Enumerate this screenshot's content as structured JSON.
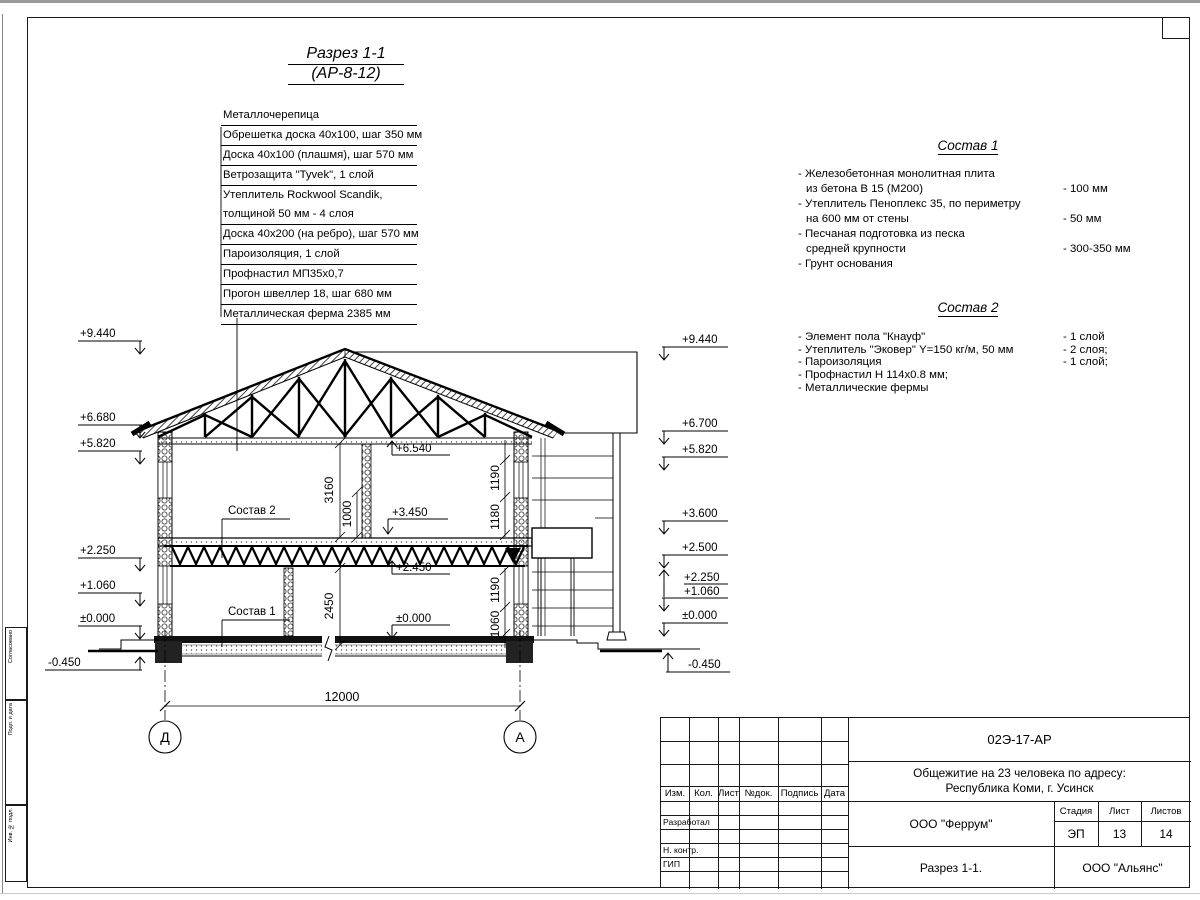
{
  "drawing_title": {
    "line1": "Разрез 1-1",
    "line2": "(АР-8-12)"
  },
  "materials": {
    "rows": [
      {
        "text": "Металлочерепица"
      },
      {
        "text": "Обрешетка доска 40х100, шаг 350 мм"
      },
      {
        "text": "Доска 40х100 (плашмя), шаг 570 мм"
      },
      {
        "text": "Ветрозащита \"Tyvek\", 1 слой"
      },
      {
        "text": "Утеплитель Rockwool Scandik,"
      },
      {
        "text": "толщиной 50 мм - 4 слоя"
      },
      {
        "text": "Доска 40х200 (на ребро), шаг 570 мм"
      },
      {
        "text": "Пароизоляция, 1 слой"
      },
      {
        "text": "Профнастил МП35х0,7"
      },
      {
        "text": "Прогон швеллер 18, шаг 680 мм"
      },
      {
        "text": "Металлическая ферма 2385 мм"
      }
    ]
  },
  "sostav1": {
    "title": "Состав 1",
    "items": [
      {
        "l1": "- Железобетонная  монолитная плита",
        "l2": "из бетона В 15 (М200)",
        "value": "- 100 мм"
      },
      {
        "l1": "- Утеплитель Пеноплекс 35, по периметру",
        "l2": "на 600 мм от стены",
        "value": "- 50 мм"
      },
      {
        "l1": "- Песчаная подготовка из песка",
        "l2": "средней крупности",
        "value": "- 300-350 мм"
      },
      {
        "l1": "- Грунт основания",
        "value": ""
      }
    ]
  },
  "sostav2": {
    "title": "Состав 2",
    "items": [
      {
        "l1": "- Элемент пола \"Кнауф\"",
        "value": "- 1 слой"
      },
      {
        "l1": "- Утеплитель \"Эковер\" Y=150 кг/м, 50 мм",
        "value": "- 2 слоя;"
      },
      {
        "l1": "- Пароизоляция",
        "value": "- 1 слой;"
      },
      {
        "l1": "- Профнастил Н 114х0.8 мм;",
        "value": ""
      },
      {
        "l1": "- Металлические фермы",
        "value": ""
      }
    ]
  },
  "drawing": {
    "elevations_left": [
      "+9.440",
      "+6.680",
      "+5.820",
      "+2.250",
      "+1.060",
      "±0.000",
      "-0.450"
    ],
    "elevations_right": [
      "+9.440",
      "+6.700",
      "+5.820",
      "+3.600",
      "+2.500",
      "+2.250",
      "+1.060",
      "±0.000",
      "-0.450"
    ],
    "elevations_inner": [
      "+6.540",
      "+3.450",
      "+2.450",
      "±0.000"
    ],
    "dims_left": [
      "3160",
      "1000",
      "2450"
    ],
    "dims_right": [
      "1190",
      "1180",
      "1190",
      "1060"
    ],
    "span_dim": "12000",
    "axes": [
      "Д",
      "А"
    ],
    "inner_labels": [
      "Состав 2",
      "Состав 1"
    ]
  },
  "titleblock": {
    "doc_number": "02Э-17-АР",
    "object_line1": "Общежитие на 23 человека по адресу:",
    "object_line2": "Республика Коми, г. Усинск",
    "designer_org": "ООО \"Феррум\"",
    "drawing_name": "Разрез 1-1.",
    "client_org": "ООО \"Альянс\"",
    "stage_label": "Стадия",
    "sheet_label": "Лист",
    "sheets_label": "Листов",
    "stage": "ЭП",
    "sheet_no": "13",
    "sheets_total": "14",
    "header_cols": [
      "Изм.",
      "Кол.",
      "Лист",
      "№док.",
      "Подпись",
      "Дата"
    ],
    "row_labels": [
      "Разработал",
      "Н. контр.",
      "ГИП"
    ]
  },
  "side_stamp": {
    "labels": [
      "Согласовано",
      "Подп. и дата",
      "Инв. № подл."
    ]
  }
}
